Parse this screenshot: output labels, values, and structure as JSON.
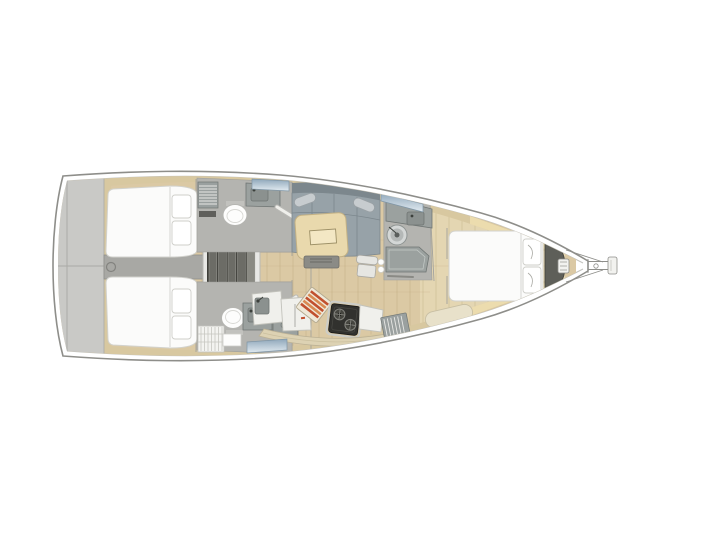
{
  "meta": {
    "alt": "Top-view interior layout plan of a sailing yacht, bow pointing right: two aft double cabins, two aft heads beside companionway stairs, salon with table and settee, galley with stove and sink, forward head, and forward owner cabin with island berth"
  },
  "palette": {
    "page_bg": "#ffffff",
    "hull_stroke": "#8e8e8a",
    "deck_line": "#c3c3bf",
    "transom": "#c9c9c6",
    "transom_seam": "#a9a9a5",
    "corridor": "#a8a8a4",
    "wood": "#dbc9a4",
    "wood_light": "#e4d6b2",
    "plank_line": "#b09a6e",
    "trim_tan": "#d8c8a0",
    "trim_bright": "#ecdcae",
    "bed_fill": "#fbfbfa",
    "bed_stroke": "#d2d2cd",
    "pillow_fill": "#ffffff",
    "pillow_stroke": "#cfcfca",
    "stairs_frame": "#e8e8e5",
    "stairs_well": "#3e3e39",
    "step_fill": "#6c6c66",
    "step_edge": "#94948e",
    "head_floor": "#b4b4b0",
    "fixture_gray": "#9ba19f",
    "fixture_dark": "#6f7573",
    "porcelain": "#fdfdfc",
    "louver": "#9aa09f",
    "louver_line": "#e8e8e5",
    "grate": "#f3f3f0",
    "grate_line": "#c6c6c1",
    "cushion": "#97a2a8",
    "cushion_dark": "#7c878d",
    "bolster": "#c7cccf",
    "table_fill": "#e9d9ad",
    "table_stroke": "#c3b184",
    "table_inner": "#f3e7c4",
    "bench_gray": "#8b8b86",
    "chair_fill": "#e6e6e2",
    "counter_fill": "#f0f0ec",
    "counter_stroke": "#c2c2bb",
    "stove_body": "#31312e",
    "stove_rim": "#cccdc8",
    "burner": "#45453f",
    "board_base": "#efe8d8",
    "board_red": "#c1502f",
    "board_orange": "#d98a52",
    "cabinet_band": "#ddd2b3",
    "locker_dark": "#5e5f59",
    "wall_line": "#a2a29d",
    "hatch_deep": "#8fa7ba",
    "hatch_pale": "#e2ebf1"
  }
}
